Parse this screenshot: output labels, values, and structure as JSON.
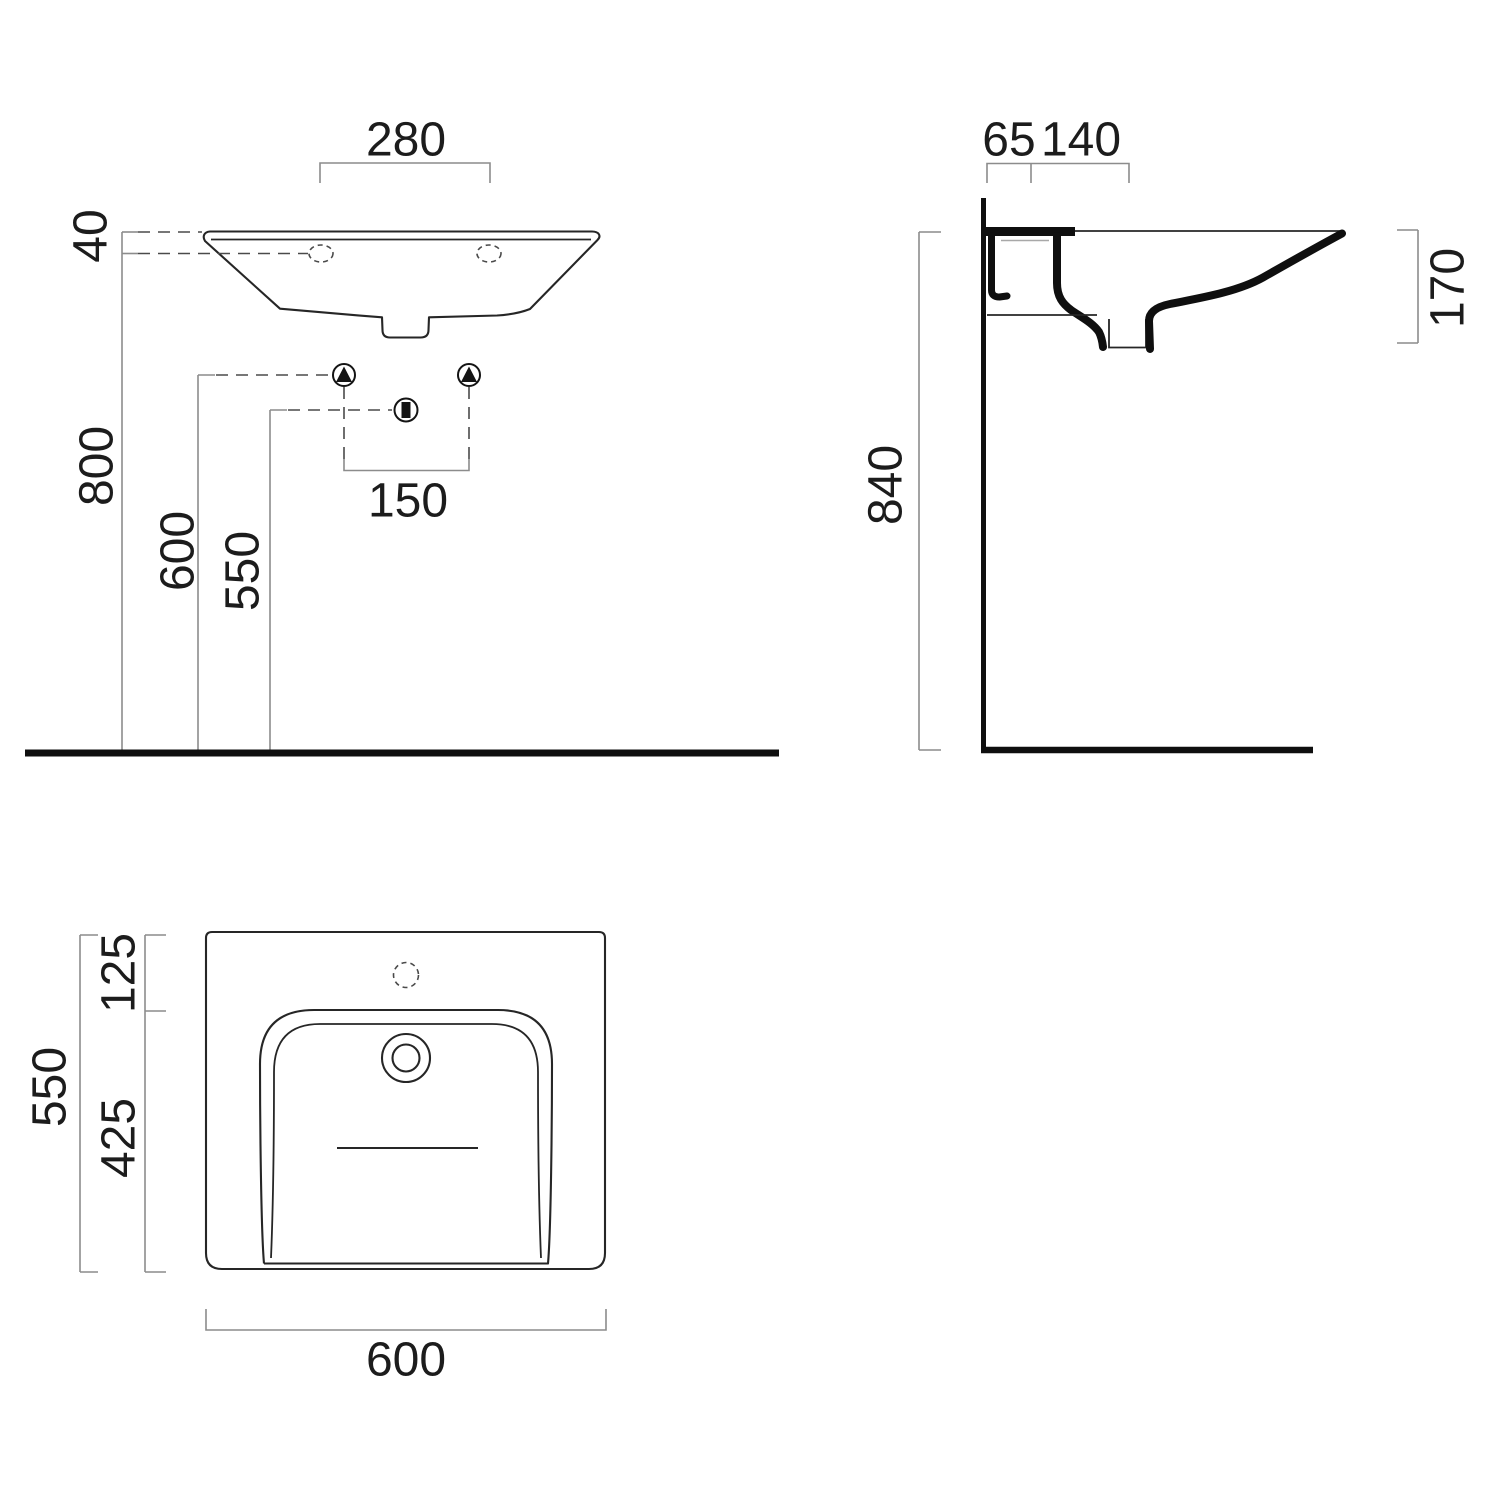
{
  "drawing": {
    "title": "wall-hung washbasin installation drawing",
    "front_view": {
      "tap_hole_spacing": "280",
      "rim_thickness": "40",
      "rim_height": "800",
      "fixing_height": "600",
      "waste_height": "550",
      "fixing_spacing": "150"
    },
    "side_view": {
      "rear_offset": "65",
      "bracket_depth": "140",
      "mounting_height": "840",
      "basin_depth": "170"
    },
    "plan_view": {
      "front_edge_to_basin": "125",
      "basin_length": "425",
      "overall_depth": "550",
      "overall_width": "600"
    }
  }
}
